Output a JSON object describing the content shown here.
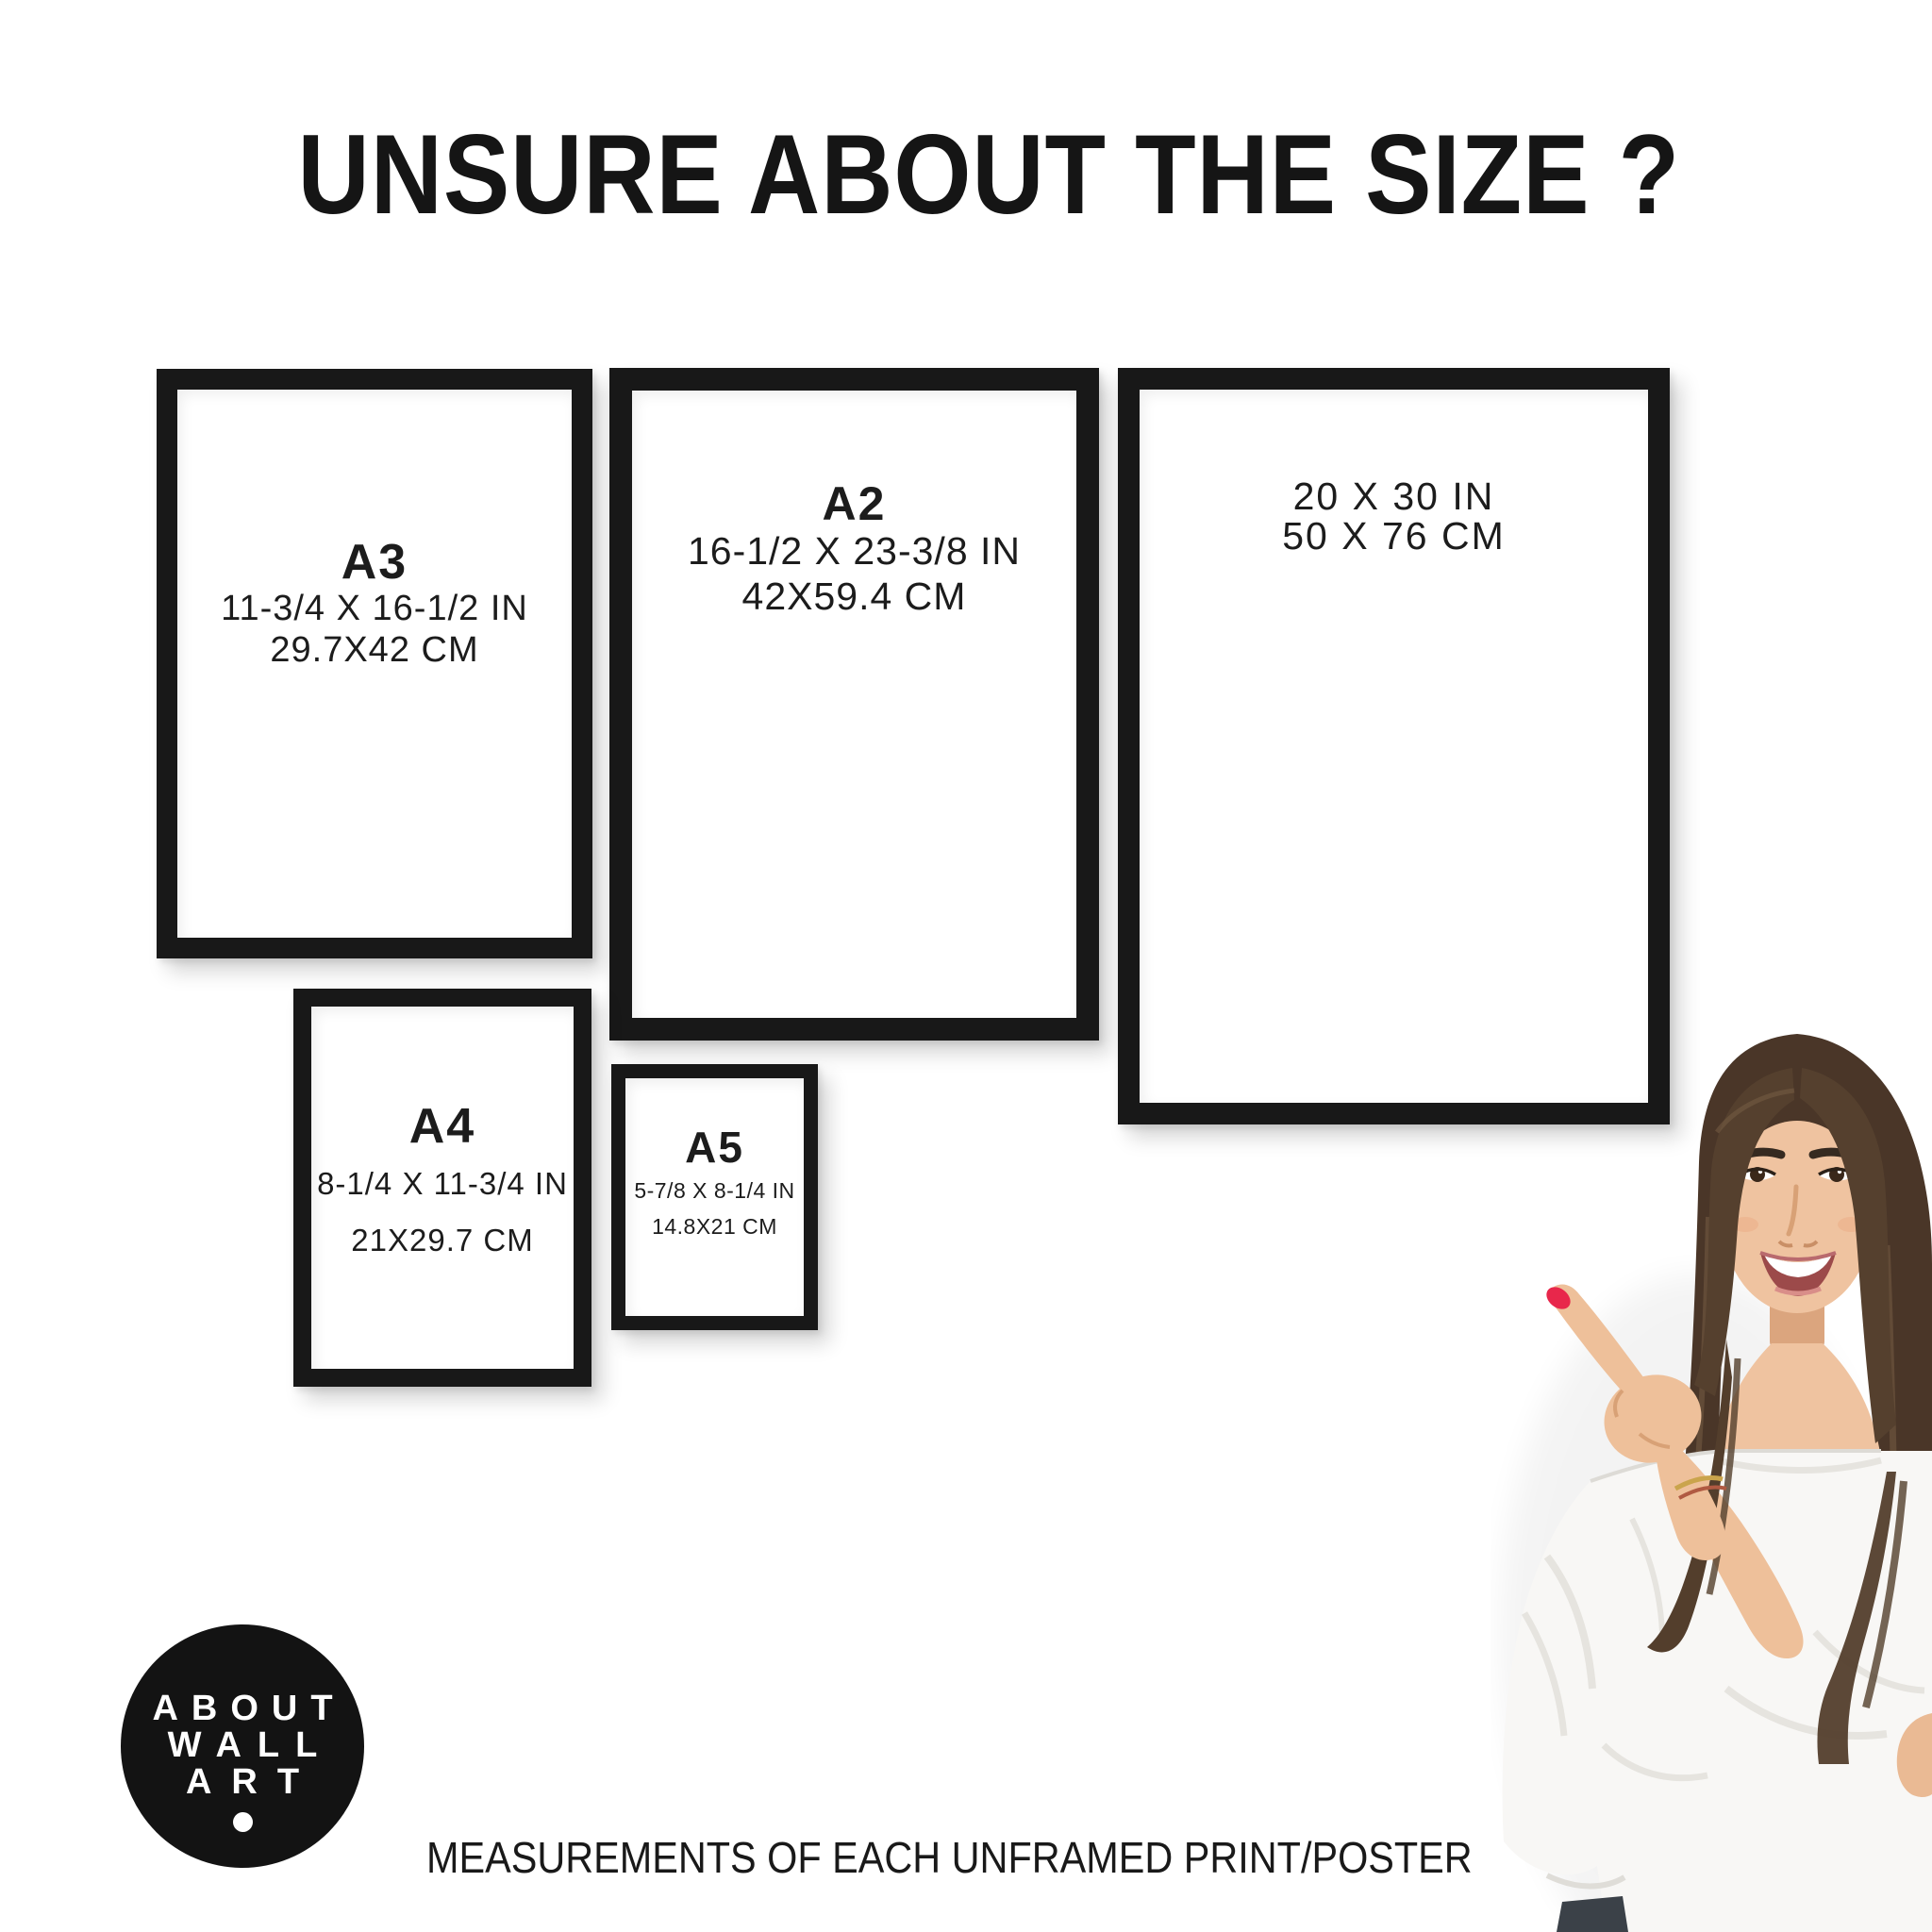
{
  "title": "UNSURE ABOUT THE SIZE ?",
  "frames": [
    {
      "label": "A3",
      "inches": "11-3/4 X 16-1/2 IN",
      "cm": "29.7X42 CM"
    },
    {
      "label": "A2",
      "inches": "16-1/2 X 23-3/8 IN",
      "cm": "42X59.4 CM"
    },
    {
      "inches": "20 X 30 IN",
      "cm": "50 X 76 CM"
    },
    {
      "label": "A4",
      "inches": "8-1/4 X 11-3/4 IN",
      "cm": "21X29.7 CM"
    },
    {
      "label": "A5",
      "inches": "5-7/8 X 8-1/4 IN",
      "cm": "14.8X21 CM"
    }
  ],
  "logo": {
    "lines": [
      "ABOUT",
      "WALL",
      "ART"
    ]
  },
  "footer": "MEASUREMENTS OF EACH UNFRAMED PRINT/POSTER",
  "colors": {
    "frame": "#181818",
    "text": "#1c1c1c",
    "background": "#ffffff",
    "logo_background": "#131313",
    "logo_text": "#ffffff",
    "nail_polish": "#e8274b",
    "hair": "#4a3628",
    "skin": "#efc3a0",
    "blouse": "#f8f7f5",
    "jeans": "#3b4148"
  }
}
